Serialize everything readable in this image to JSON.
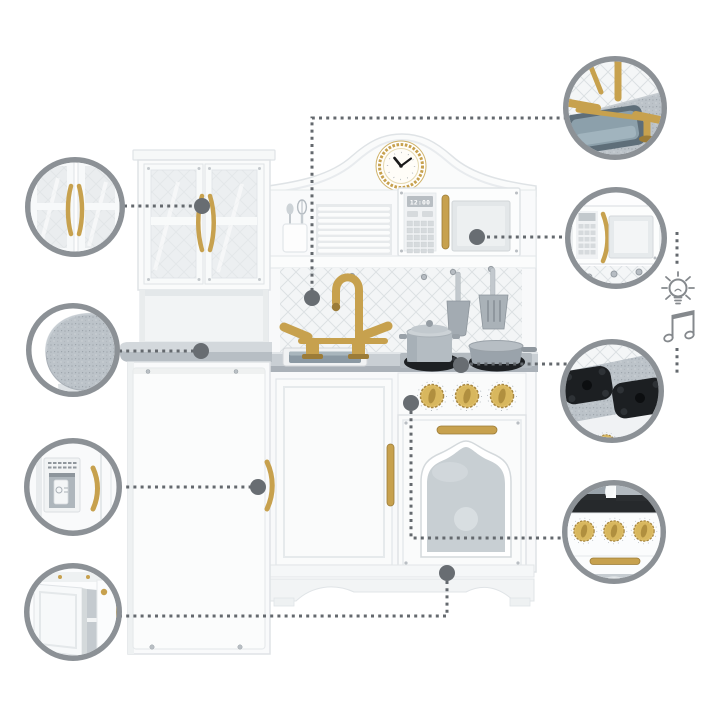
{
  "kitchen": {
    "microwave_display": "12:00",
    "clock_time": "10:10"
  },
  "callouts": [
    {
      "id": 1,
      "name": "glass-door-cabinet",
      "side": "left"
    },
    {
      "id": 2,
      "name": "rounded-counter-corner",
      "side": "left"
    },
    {
      "id": 3,
      "name": "fridge-dispenser",
      "side": "left"
    },
    {
      "id": 4,
      "name": "open-storage-cabinet",
      "side": "left"
    },
    {
      "id": 5,
      "name": "sink-and-gold-faucet",
      "side": "right"
    },
    {
      "id": 6,
      "name": "microwave",
      "side": "right"
    },
    {
      "id": 7,
      "name": "stove-burners",
      "side": "right"
    },
    {
      "id": 8,
      "name": "oven-knobs",
      "side": "right"
    }
  ],
  "feature_icons": [
    {
      "name": "light-bulb-icon",
      "meaning": "light"
    },
    {
      "name": "music-note-icon",
      "meaning": "sound"
    }
  ],
  "colors": {
    "background": "#ffffff",
    "gold_accent": "#c7a14e",
    "gold_dark": "#9c7c38",
    "ring_gray": "#8c9196",
    "dash_gray": "#64696e",
    "dot_gray": "#686d72",
    "counter_gray": "#c9cfd4",
    "burner_black": "#1d2023",
    "basin_gray": "#8b99a3"
  }
}
